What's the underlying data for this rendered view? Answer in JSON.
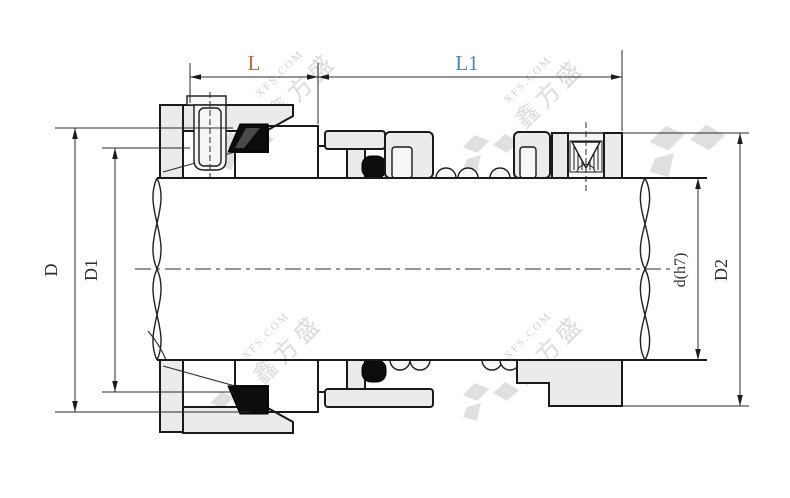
{
  "drawing": {
    "title_hint": "mechanical seal cross-section",
    "dim_labels": {
      "seal_length": "L",
      "working_length": "L1",
      "gland_outer_dia": "D",
      "gland_inner_dia": "D1",
      "shaft_dia": "d(h7)",
      "collar_outer_dia": "D2"
    },
    "watermark": {
      "site": "XFS.COM",
      "brand": "鑫方盛"
    },
    "colors": {
      "stationary_seat": "#25c5f2",
      "rotary_face": "#87de0f",
      "metal_fill": "#ebebeb",
      "elastomer": "#0d0d0d",
      "label_L": "#bf6a2d",
      "label_L1": "#4a82c4",
      "watermark_gray": "#d0d0d0"
    }
  }
}
